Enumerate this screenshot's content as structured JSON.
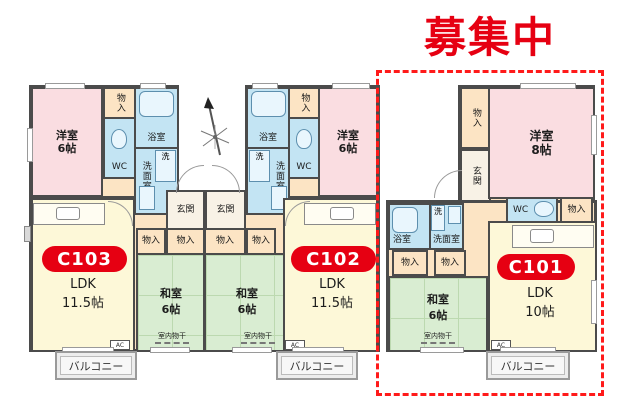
{
  "banner": {
    "text": "募集中",
    "color": "#e60012"
  },
  "highlight": {
    "unit": "C101",
    "border_style": "red-dashed-outline",
    "border_color": "#ff1a1a"
  },
  "compass": {
    "icon": "north-arrow"
  },
  "colors": {
    "wall": "#4b4b4b",
    "western_room": "#fadde1",
    "japanese_room": "#d9edd2",
    "ldk_room": "#fdf8d8",
    "wet_area": "#c3e4f3",
    "closet": "#fce4c4",
    "balcony": "#ededed",
    "badge": "#e60012"
  },
  "labels": {
    "western": "洋室",
    "japanese": "和室",
    "ldk": "LDK",
    "bath": "浴室",
    "wc": "WC",
    "washroom": "洗面室",
    "washer": "洗",
    "storage": "物入",
    "entrance": "玄関",
    "indoor_drying": "室内物干",
    "balcony": "バルコニー",
    "ac": "AC"
  },
  "units": [
    {
      "badge": "C103",
      "ldk_size": "11.5帖",
      "western_size": "6帖",
      "japanese_size": "6帖"
    },
    {
      "badge": "C102",
      "ldk_size": "11.5帖",
      "western_size": "6帖",
      "japanese_size": "6帖"
    },
    {
      "badge": "C101",
      "ldk_size": "10帖",
      "western_size": "8帖",
      "japanese_size": "6帖"
    }
  ]
}
